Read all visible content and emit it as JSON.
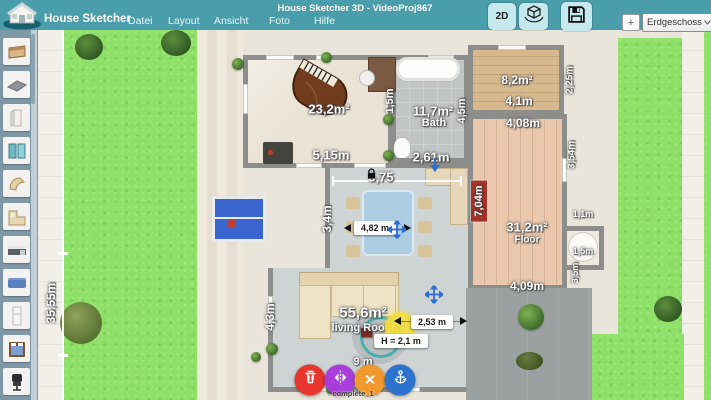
{
  "titlebar": {
    "app_name": "House Sketcher",
    "window_title": "House Sketcher 3D - VideoProj867",
    "menus": [
      "Datei",
      "Layout",
      "Ansicht",
      "Foto",
      "Hilfe"
    ],
    "mode_2d": "2D",
    "add_floor": "+",
    "floor_selector": "Erdgeschoss",
    "accent_color": "#4a9daa"
  },
  "sidebar": {
    "items": [
      "single-bed",
      "floor-panel",
      "door",
      "double-window",
      "chaise-longue",
      "corner-sofa",
      "kitchen-unit",
      "blue-sofa",
      "cabinet",
      "double-bed",
      "office-chair"
    ]
  },
  "plan": {
    "lot_width": "35,55m",
    "labels": {
      "music_room": {
        "area": "23,2m²",
        "width": "5,15m",
        "right": "1,5m"
      },
      "bath": {
        "area": "11,7m²",
        "name": "Bath",
        "right": "4,5m",
        "width": "2,61m"
      },
      "hall_top": "5,75",
      "storage": {
        "area": "8,2m²",
        "width": "4,1m",
        "right": "2,25m"
      },
      "floor_room": {
        "area": "31,2m²",
        "name": "Floor",
        "top": "4,08m",
        "bottom": "4,09m",
        "left": "7,04m",
        "right": "3,54m",
        "alcove_top": "1,1m",
        "alcove_mid": "1,5m",
        "alcove_right": "3,5m"
      },
      "dining": {
        "left": "3,4m"
      },
      "living": {
        "area": "55,6m²",
        "name": "living Room",
        "left": "4,3m",
        "bottom": "9 m"
      }
    },
    "badges": {
      "table_width": "4,82 m",
      "distance": "2,53 m",
      "object_height": "H = 2,1 m"
    },
    "selected_object": "complete_1"
  }
}
